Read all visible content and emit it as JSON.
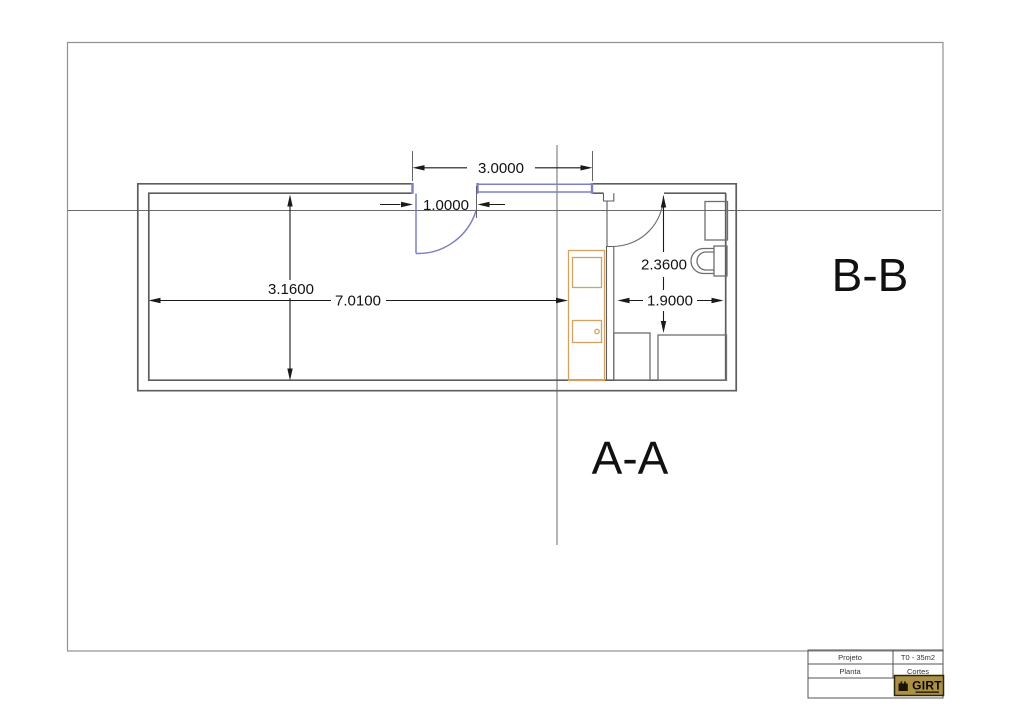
{
  "drawing_type": "architectural-floor-plan",
  "sections": {
    "vertical_label": "A-A",
    "horizontal_label": "B-B"
  },
  "dimensions": {
    "top_span": "3.0000",
    "entry_door": "1.0000",
    "interior_depth": "3.1600",
    "interior_width": "7.0100",
    "bath_depth": "2.3600",
    "bath_width": "1.9000"
  },
  "title_block": {
    "row1_label": "Projeto",
    "row1_value": "T0 - 35m2",
    "row2_label": "Planta",
    "row2_value": "Cortes",
    "logo_text": "GIRT"
  },
  "colors": {
    "wall_gray": "#5d5d5d",
    "window_blue": "#7c80c4",
    "furniture_orange": "#d2a263",
    "dimension_black": "#1a1a1a",
    "logo_gold": "#ab9045"
  }
}
